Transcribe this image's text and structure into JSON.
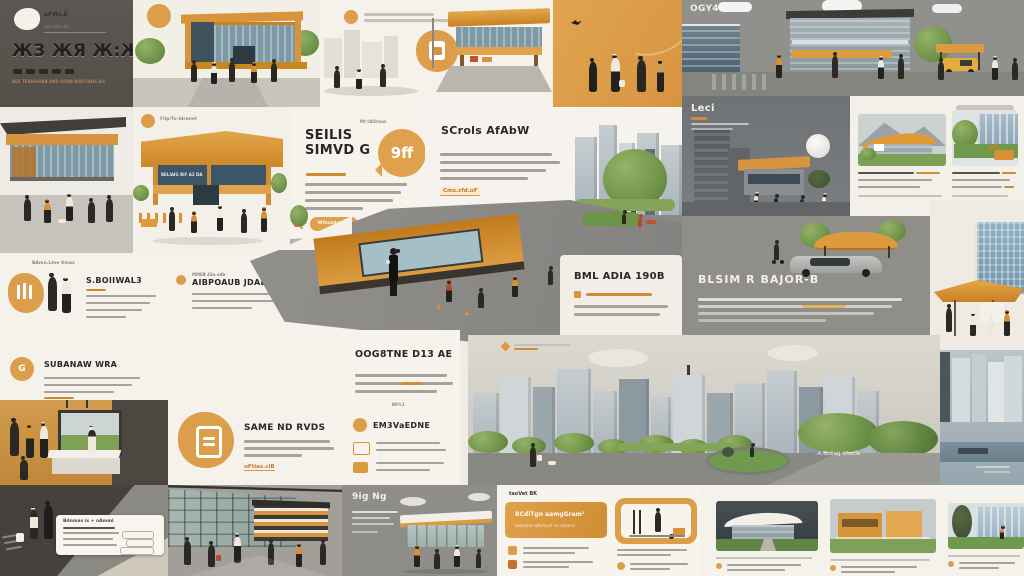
{
  "colors": {
    "accent_orange": "#dd9e4b",
    "deep_orange": "#c97f26",
    "cream": "#f5f1ea",
    "slate_gray": "#8f8e89",
    "charcoal": "#45423d",
    "dark_panel": "#57534e",
    "tree_green": "#6e9448",
    "glass_blue": "#8fb0c2"
  },
  "slides": {
    "dark_title": {
      "logo_caption": "aPИʌ.E",
      "logo_subcaption": "atst tote dm",
      "title": "ЖЗ ЖЯ Ж:Ж",
      "footnote": "BES TESHIIGIAB AND SORN BOSTIAHS AG"
    },
    "city_top": {
      "title": "OGY4"
    },
    "orange_awning": {
      "caption": "Flip/To-Idronet",
      "sign": "BELIAIG BIF A2 DA"
    },
    "headline_bubble": {
      "caption": "Mt tAStmas",
      "title_line1": "SEILIS",
      "title_line2": "SIMVD G",
      "bubble": "9ff",
      "button_label": "Wfmaste can"
    },
    "scrols": {
      "title": "SCrols AfAbW",
      "link": "Cms.cfd.uF"
    },
    "leci": {
      "title": "Leci"
    },
    "bml": {
      "title": "BML ADIA 190B"
    },
    "pavilion_car": {
      "title": "BLSIM R BAJOR-B"
    },
    "park": {
      "road_label": ".A Bidiag dAscia"
    },
    "oog": {
      "title": "OOG8TNE D13 AE",
      "mini": "B9%1",
      "subtitle": "EM3VaEDNE"
    },
    "features": {
      "caption": "BAmn.LIne Vmas",
      "item1_title": "S.BOIIWAL3",
      "item2_top": "MMEB 43a odb",
      "item2_title": "AIBPOAUB JDAEH",
      "item3_badge": "G",
      "item3_title": "SUBANAW WRA"
    },
    "door_card": {
      "title": "SAME ND RVDS",
      "link": "uFtias.ciB"
    },
    "dark_box": {
      "box_header": "Bdnmas is + nAmml"
    },
    "ngng": {
      "title": "9ig Ng"
    },
    "banner": {
      "caption": "taoVet BK",
      "line1": "BCdiTgn aamgGram¹",
      "line2": "saanmas wAsmpcf vs.camans"
    }
  }
}
